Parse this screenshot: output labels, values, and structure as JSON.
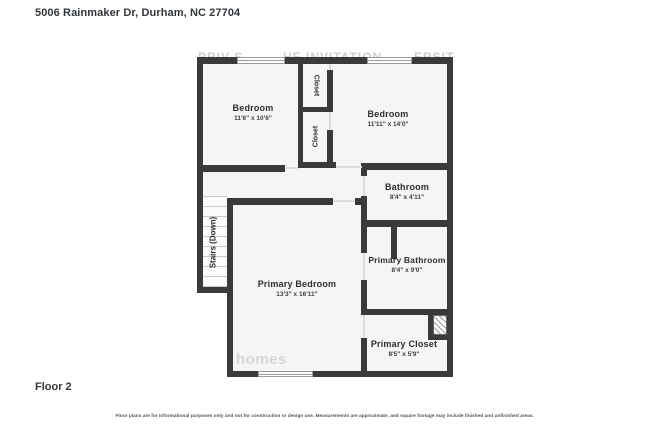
{
  "page": {
    "title": "5006 Rainmaker Dr, Durham, NC 27704",
    "floor_label": "Floor 2",
    "disclaimer": "Floor plans are for informational purposes only and not for construction or design use. Measurements are approximate, and square footage may include finished and unfinished areas."
  },
  "colors": {
    "wall": "#3a3a3a",
    "room_fill": "#f5f5f4",
    "text": "#2e2e2e",
    "window_frame": "#9a9a9a",
    "background": "#ffffff"
  },
  "rooms": {
    "bedroom1": {
      "name": "Bedroom",
      "dims": "11'6\" x 10'6\""
    },
    "bedroom2": {
      "name": "Bedroom",
      "dims": "11'11\" x 14'0\""
    },
    "closet_top": {
      "name": "Closet"
    },
    "closet_bottom": {
      "name": "Closet"
    },
    "bathroom": {
      "name": "Bathroom",
      "dims": "8'4\" x 4'11\""
    },
    "primary_bathroom": {
      "name": "Primary Bathroom",
      "dims": "8'4\" x 9'0\""
    },
    "primary_bedroom": {
      "name": "Primary Bedroom",
      "dims": "13'3\" x 16'11\""
    },
    "primary_closet": {
      "name": "Primary Closet",
      "dims": "8'5\" x 5'9\""
    },
    "stairs": {
      "name": "Stairs (Down)"
    }
  },
  "watermarks": {
    "top_fragments": [
      "PRIV S",
      "HE INVITATION",
      "ERSIT"
    ],
    "bottom": "homes"
  }
}
